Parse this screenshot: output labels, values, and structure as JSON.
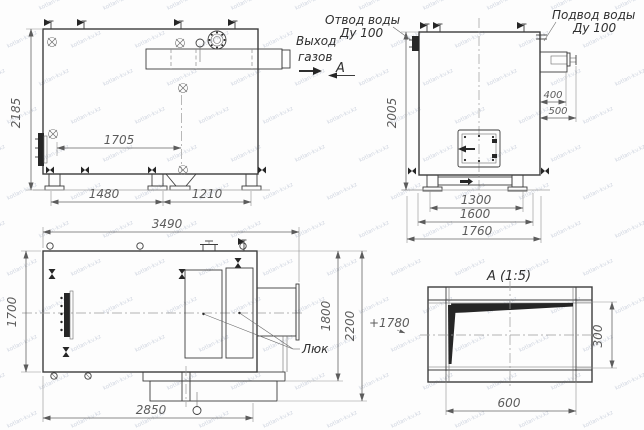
{
  "watermark": "kotlan-kv.kz",
  "front_view": {
    "gas_outlet_label": {
      "line1": "Выход",
      "line2": "газов"
    },
    "section_label": "A",
    "dim_height": "2185",
    "dim_burner_span": "1705",
    "dim_base_left": "1480",
    "dim_base_right": "1210"
  },
  "side_view": {
    "water_outlet_label": {
      "line1": "Отвод воды",
      "line2": "Ду 100"
    },
    "water_inlet_label": {
      "line1": "Подвод воды",
      "line2": "Ду 100"
    },
    "dim_height": "2005",
    "dim_header_depth": "400",
    "dim_header_total": "500",
    "dim_base_inner": "1300",
    "dim_base_mid": "1600",
    "dim_base_outer": "1760"
  },
  "plan_view": {
    "hatch_label": "Люк",
    "elevation_label": "+1780",
    "dim_length": "3490",
    "dim_width": "1700",
    "dim_ext_first": "1800",
    "dim_ext_total": "2200",
    "dim_bottom": "2850"
  },
  "detail_view": {
    "title": "A (1:5)",
    "dim_width": "600",
    "dim_height": "300"
  },
  "colors": {
    "line": "#3c3c3c",
    "dimension_text": "#5c5c5c",
    "label_text": "#2e2e2e",
    "watermark": "#aab4c8"
  }
}
